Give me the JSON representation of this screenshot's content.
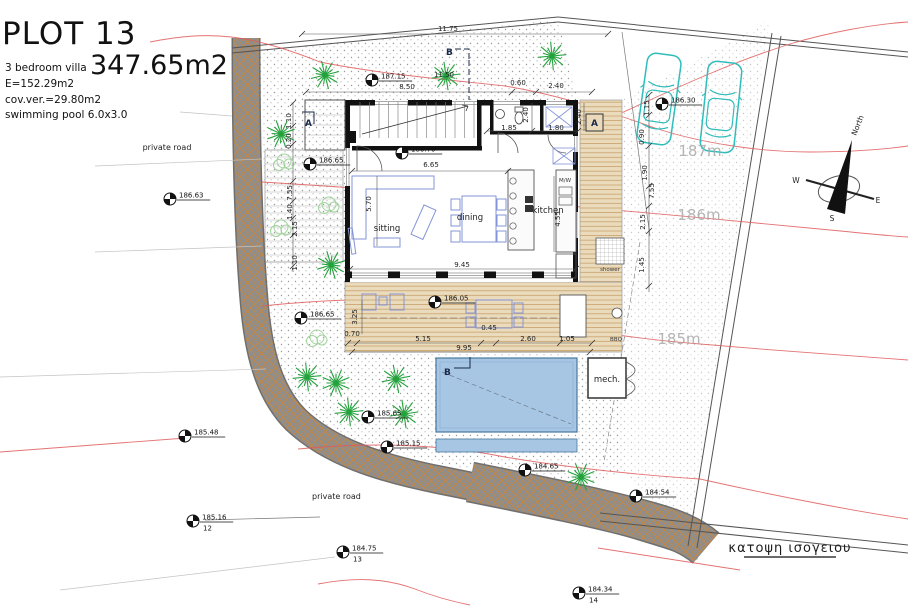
{
  "title_block": {
    "plot": "PLOT 13",
    "area": "347.65m2",
    "line1": "3 bedroom villa",
    "line2": "E=152.29m2",
    "line3": "cov.ver.=29.80m2",
    "line4": "swimming pool 6.0x3.0"
  },
  "caption": "κατοψη ισογειου",
  "compass": {
    "north": "North",
    "w": "W",
    "e": "E",
    "s": "S"
  },
  "labels": {
    "sitting": "sitting",
    "dining": "dining",
    "kitchen": "kitchen",
    "shower": "shower",
    "mech": "mech.",
    "bbq": "BBQ",
    "mw": "M/W",
    "private_road_top": "private road",
    "private_road_bottom": "private road"
  },
  "section_marks": {
    "b_top": "B",
    "a_left": "A",
    "a_right": "A",
    "b_bottom": "B"
  },
  "contour_labels": [
    {
      "text": "187m",
      "x": 700,
      "y": 156
    },
    {
      "text": "186m",
      "x": 699,
      "y": 220
    },
    {
      "text": "185m",
      "x": 679,
      "y": 344
    }
  ],
  "survey_points": [
    {
      "v": "187.15",
      "x": 372,
      "y": 80
    },
    {
      "v": "186.30",
      "x": 662,
      "y": 104
    },
    {
      "v": "186.70",
      "x": 402,
      "y": 153
    },
    {
      "v": "186.65",
      "x": 310,
      "y": 164
    },
    {
      "v": "186.63",
      "x": 170,
      "y": 199
    },
    {
      "v": "186.65",
      "x": 301,
      "y": 318
    },
    {
      "v": "186.05",
      "x": 435,
      "y": 302
    },
    {
      "v": "185.48",
      "x": 185,
      "y": 436
    },
    {
      "v": "185.16",
      "x": 193,
      "y": 521,
      "n": "12"
    },
    {
      "v": "185.65",
      "x": 368,
      "y": 417
    },
    {
      "v": "185.15",
      "x": 387,
      "y": 447
    },
    {
      "v": "184.65",
      "x": 525,
      "y": 470
    },
    {
      "v": "184.54",
      "x": 636,
      "y": 496
    },
    {
      "v": "184.75",
      "x": 343,
      "y": 552,
      "n": "13"
    },
    {
      "v": "184.34",
      "x": 579,
      "y": 593,
      "n": "14"
    }
  ],
  "dimensions": [
    {
      "t": "11.75",
      "x": 448,
      "y": 31
    },
    {
      "t": "11.50",
      "x": 444,
      "y": 77
    },
    {
      "t": "8.50",
      "x": 407,
      "y": 89
    },
    {
      "t": "0.60",
      "x": 518,
      "y": 85
    },
    {
      "t": "2.40",
      "x": 556,
      "y": 88
    },
    {
      "t": "2.40",
      "x": 528,
      "y": 115,
      "r": -90
    },
    {
      "t": "2.40",
      "x": 581,
      "y": 117,
      "r": -90
    },
    {
      "t": "1.85",
      "x": 509,
      "y": 130
    },
    {
      "t": "1.80",
      "x": 556,
      "y": 130
    },
    {
      "t": "6.65",
      "x": 431,
      "y": 167
    },
    {
      "t": "5.70",
      "x": 371,
      "y": 204,
      "r": -90
    },
    {
      "t": "4.55",
      "x": 560,
      "y": 219,
      "r": -90
    },
    {
      "t": "9.45",
      "x": 462,
      "y": 267
    },
    {
      "t": "0.70",
      "x": 352,
      "y": 336
    },
    {
      "t": "3.25",
      "x": 357,
      "y": 317,
      "r": -90
    },
    {
      "t": "5.15",
      "x": 423,
      "y": 341
    },
    {
      "t": "0.45",
      "x": 489,
      "y": 330
    },
    {
      "t": "2.60",
      "x": 528,
      "y": 341
    },
    {
      "t": "1.05",
      "x": 567,
      "y": 341
    },
    {
      "t": "9.95",
      "x": 464,
      "y": 350
    },
    {
      "t": "1.10",
      "x": 291,
      "y": 121,
      "r": -90
    },
    {
      "t": "0.20",
      "x": 291,
      "y": 141,
      "r": -90
    },
    {
      "t": "7.55",
      "x": 292,
      "y": 193,
      "r": -90
    },
    {
      "t": "1.40",
      "x": 292,
      "y": 212,
      "r": -90
    },
    {
      "t": "2.15",
      "x": 297,
      "y": 229,
      "r": -90
    },
    {
      "t": "1.10",
      "x": 297,
      "y": 263,
      "r": -90
    },
    {
      "t": "1.15",
      "x": 649,
      "y": 108,
      "r": -90
    },
    {
      "t": "0.90",
      "x": 644,
      "y": 137,
      "r": -90
    },
    {
      "t": "1.90",
      "x": 647,
      "y": 173,
      "r": -90
    },
    {
      "t": "7.55",
      "x": 654,
      "y": 191,
      "r": -90
    },
    {
      "t": "2.15",
      "x": 645,
      "y": 222,
      "r": -90
    },
    {
      "t": "1.45",
      "x": 644,
      "y": 265,
      "r": -90
    }
  ],
  "landscape": {
    "palm_trees": [
      [
        325,
        75
      ],
      [
        446,
        76
      ],
      [
        552,
        56
      ],
      [
        281,
        134
      ],
      [
        331,
        265
      ],
      [
        307,
        377
      ],
      [
        336,
        383
      ],
      [
        396,
        379
      ],
      [
        349,
        412
      ],
      [
        404,
        414
      ],
      [
        581,
        477
      ]
    ],
    "bushes": [
      [
        284,
        161
      ],
      [
        281,
        227
      ],
      [
        329,
        204
      ],
      [
        317,
        337
      ]
    ]
  },
  "colors": {
    "contour_red": "#e05a5a",
    "contour_label_gray": "#a9a9a9",
    "car_teal": "#2fbdbb",
    "pool_blue": "#a7c6e4",
    "deck_tan": "#eadbbd",
    "deck_line": "#c9a26b",
    "road_gray": "#8e8e8e",
    "road_hatch_orange": "#c8863c",
    "tree_green": "#23a23c",
    "bush_green": "#a2d49e",
    "furniture_blue": "#8494d8"
  }
}
